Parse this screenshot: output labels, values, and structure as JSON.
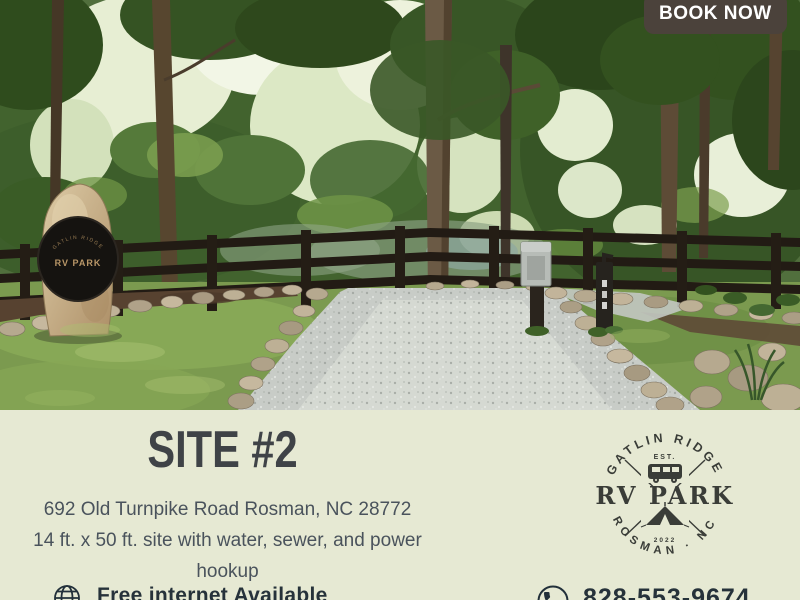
{
  "cta": {
    "label": "BOOK NOW"
  },
  "info": {
    "site_title": "SITE #2",
    "address": "692  Old Turnpike Road Rosman, NC 28772",
    "details": "14 ft. x 50 ft. site with water, sewer, and power hookup"
  },
  "logo": {
    "arc_top": "GATLIN RIDGE",
    "est_label": "EST.",
    "name": "RV PARK",
    "year": "2022",
    "arc_bottom": "ROSMAN · NC"
  },
  "monument": {
    "arc_text": "GATLIN RIDGE",
    "plaque_label": "RV PARK"
  },
  "footer": {
    "internet_note": "Free internet Available",
    "phone": "828-553-9674"
  },
  "colors": {
    "background_cream": "#e6e9d3",
    "cta_background": "#4b423b",
    "heading_text": "#3f4347",
    "body_text": "#4a535c",
    "logo_ink": "#3a3d38"
  }
}
